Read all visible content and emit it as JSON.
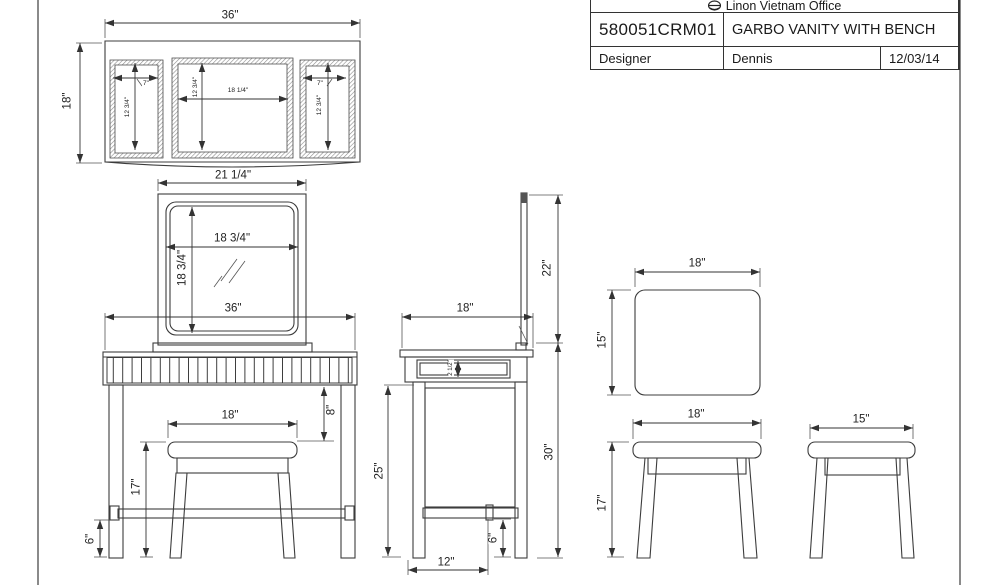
{
  "title_block": {
    "company": "Linon Vietnam Office",
    "logo_icon": "linon-logo-icon",
    "part_number": "580051CRM01",
    "product_name": "GARBO VANITY WITH BENCH",
    "designer_label": "Designer",
    "designer_name": "Dennis",
    "date": "12/03/14"
  },
  "views": {
    "trifold_mirror_front": {
      "overall_width": "36\"",
      "overall_height": "18\"",
      "left_panel_width": "7\"",
      "left_panel_height": "12 3/4\"",
      "center_panel_width": "18 1/4\"",
      "center_panel_height": "12 3/4\"",
      "right_panel_width": "7\"",
      "right_panel_height": "12 3/4\""
    },
    "vanity_front": {
      "mirror_frame_width": "21 1/4\"",
      "mirror_glass_width": "18 3/4\"",
      "mirror_glass_height": "18 3/4\"",
      "table_width": "36\"",
      "apron_to_seat": "8\"",
      "stool_seat_width": "18\"",
      "stool_height": "17\"",
      "stretcher_height": "6\""
    },
    "vanity_side": {
      "depth": "18\"",
      "mirror_above_table": "22\"",
      "drawer_inside_height": "2 1/2\"",
      "under_table_height": "25\"",
      "table_height": "30\"",
      "stretcher_height": "6\"",
      "foot_span": "12\""
    },
    "bench_top": {
      "seat_width": "18\"",
      "seat_depth": "15\""
    },
    "bench_front": {
      "width": "18\"",
      "height": "17\""
    },
    "bench_side": {
      "depth": "15\""
    }
  }
}
